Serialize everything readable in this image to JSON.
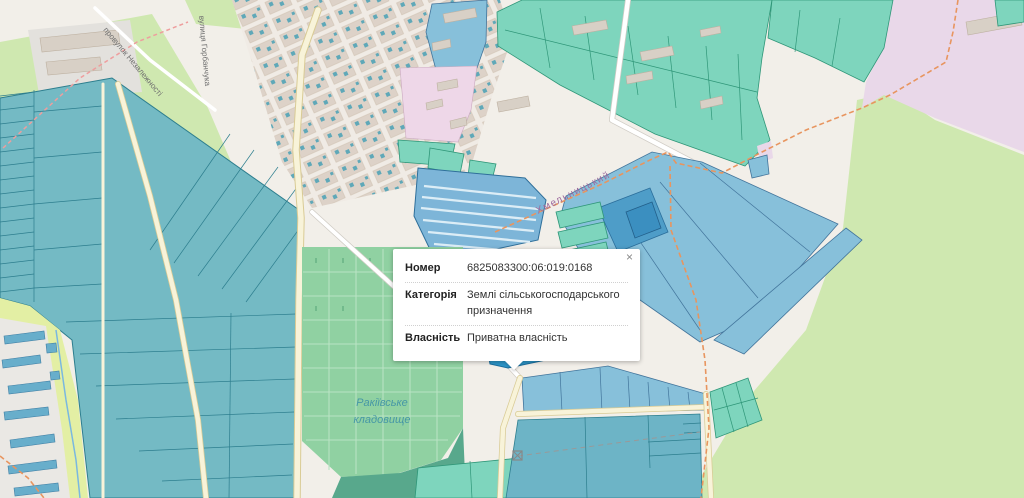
{
  "popup": {
    "close": "×",
    "rows": [
      {
        "label": "Номер",
        "value": "6825083300:06:019:0168"
      },
      {
        "label": "Категорія",
        "value": "Землі сільськогосподарського призначення"
      },
      {
        "label": "Власність",
        "value": "Приватна власність"
      }
    ]
  },
  "map": {
    "labels": {
      "lane": "провулок Незалежності",
      "street": "вулиця Горбанчука",
      "district": "Хмельницький",
      "cemetery_line1": "Ракіївське",
      "cemetery_line2": "кладовище"
    },
    "colors": {
      "background": "#f2efe9",
      "grass": "#cfe8b0",
      "meadow": "#e3efa4",
      "residential": "#e3e1dd",
      "building": "#d8d0c6",
      "parcel_teal": "#74bac4",
      "parcel_teal_border": "#2d7e8e",
      "parcel_blue": "#87c0da",
      "parcel_blue_border": "#42749b",
      "parcel_mint": "#7ed5bd",
      "parcel_mint_border": "#2f9678",
      "parcel_selected": "#2d95c8",
      "cemetery_green": "#90d1a2",
      "military_pink": "#e9d8e9",
      "road_cream": "#f8f3d9",
      "path_orange": "#e8955f",
      "water_blue": "#7ab8e0",
      "street_label": "#6f6f6f",
      "district_label": "#9d6a9e",
      "cemetery_label": "#4697a6"
    }
  }
}
